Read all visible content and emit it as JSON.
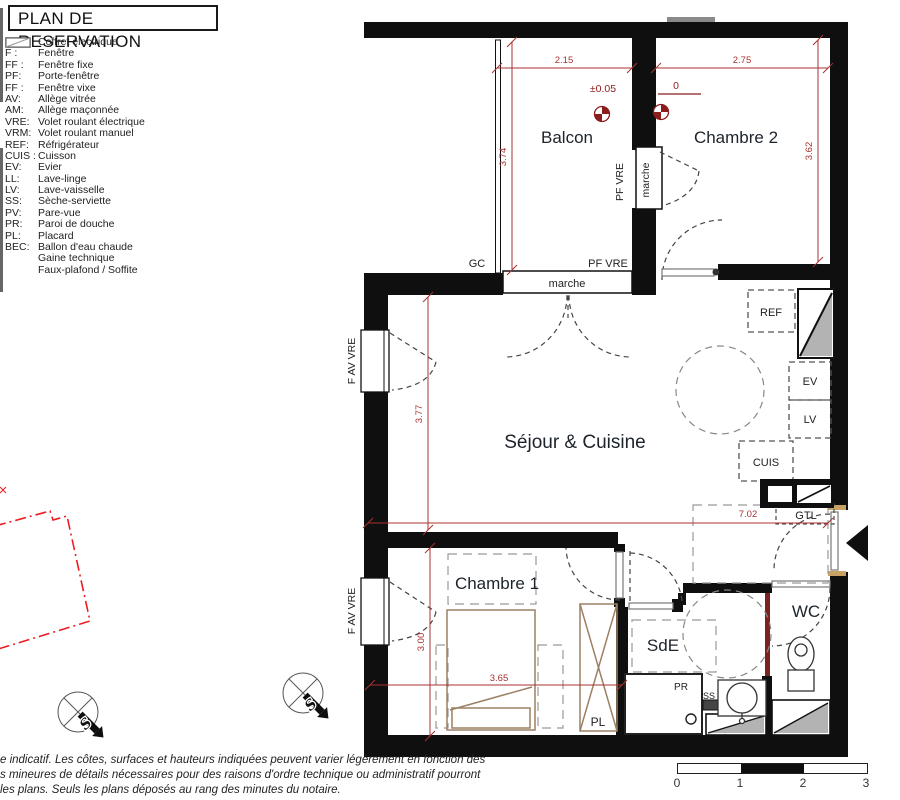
{
  "legend": {
    "title": "PLAN DE RESERVATION",
    "items": [
      {
        "abbr": "GTL:",
        "label": "Coffret électrique"
      },
      {
        "abbr": "F :",
        "label": "Fenêtre"
      },
      {
        "abbr": "FF :",
        "label": "Fenêtre fixe"
      },
      {
        "abbr": "PF:",
        "label": "Porte-fenêtre"
      },
      {
        "abbr": "FF :",
        "label": "Fenêtre vixe"
      },
      {
        "abbr": "AV:",
        "label": "Allège vitrée"
      },
      {
        "abbr": "AM:",
        "label": "Allège maçonnée"
      },
      {
        "abbr": "VRE:",
        "label": "Volet roulant électrique"
      },
      {
        "abbr": "VRM:",
        "label": "Volet roulant manuel"
      },
      {
        "abbr": "REF:",
        "label": "Réfrigérateur"
      },
      {
        "abbr": "CUIS :",
        "label": "Cuisson"
      },
      {
        "abbr": "EV:",
        "label": "Evier"
      },
      {
        "abbr": "LL:",
        "label": "Lave-linge"
      },
      {
        "abbr": "LV:",
        "label": "Lave-vaisselle"
      },
      {
        "abbr": "SS:",
        "label": "Sèche-serviette"
      },
      {
        "abbr": "PV:",
        "label": "Pare-vue"
      },
      {
        "abbr": "PR:",
        "label": "Paroi de douche"
      },
      {
        "abbr": "PL:",
        "label": "Placard"
      },
      {
        "abbr": "BEC:",
        "label": "Ballon d'eau chaude"
      }
    ],
    "symbol_items": [
      {
        "icon": "gaine-hatch-icon",
        "label": "Gaine technique"
      },
      {
        "icon": "soffite-hatch-icon",
        "label": "Faux-plafond / Soffite"
      }
    ]
  },
  "plan": {
    "rooms": {
      "balcon": "Balcon",
      "chambre2": "Chambre 2",
      "sejour": "Séjour & Cuisine",
      "chambre1": "Chambre 1",
      "sde": "SdE",
      "wc": "WC"
    },
    "labels": {
      "gc": "GC",
      "pf_vre_top": "PF VRE",
      "pf_vre_side": "PF VRE",
      "marche_top": "marche",
      "marche_side": "marche",
      "f_av_vre_1": "F AV VRE",
      "f_av_vre_2": "F AV VRE",
      "ref": "REF",
      "ev": "EV",
      "lv": "LV",
      "cuis": "CUIS",
      "gtl": "GTL",
      "pr": "PR",
      "ss": "SS",
      "pl": "PL"
    },
    "dimensions": {
      "d215": "2.15",
      "d275": "2.75",
      "d374": "3.74",
      "d362": "3.62",
      "d377": "3.77",
      "d702": "7.02",
      "d365": "3.65",
      "d300": "3.00"
    },
    "levels": {
      "balcon": "±0.05",
      "chambre2": "0"
    },
    "compass": {
      "letter": "S"
    }
  },
  "scalebar": {
    "labels": [
      "0",
      "1",
      "2",
      "3"
    ]
  },
  "disclaimer": {
    "lines": [
      "e indicatif. Les côtes, surfaces et hauteurs indiquées peuvent varier légèrement en fonction des",
      "s mineures de détails nécessaires pour des raisons d'ordre technique ou administratif pourront",
      "les plans. Seuls les plans déposés au rang des minutes du notaire."
    ]
  },
  "colors": {
    "wall": "#0f0f0f",
    "dimension_red": "#a83232",
    "level_marker_red": "#8b1d1d",
    "adjacent_unit_red": "#ed1c24",
    "partition_dark_red": "#7a2121",
    "furniture_tan": "#9b8164"
  }
}
